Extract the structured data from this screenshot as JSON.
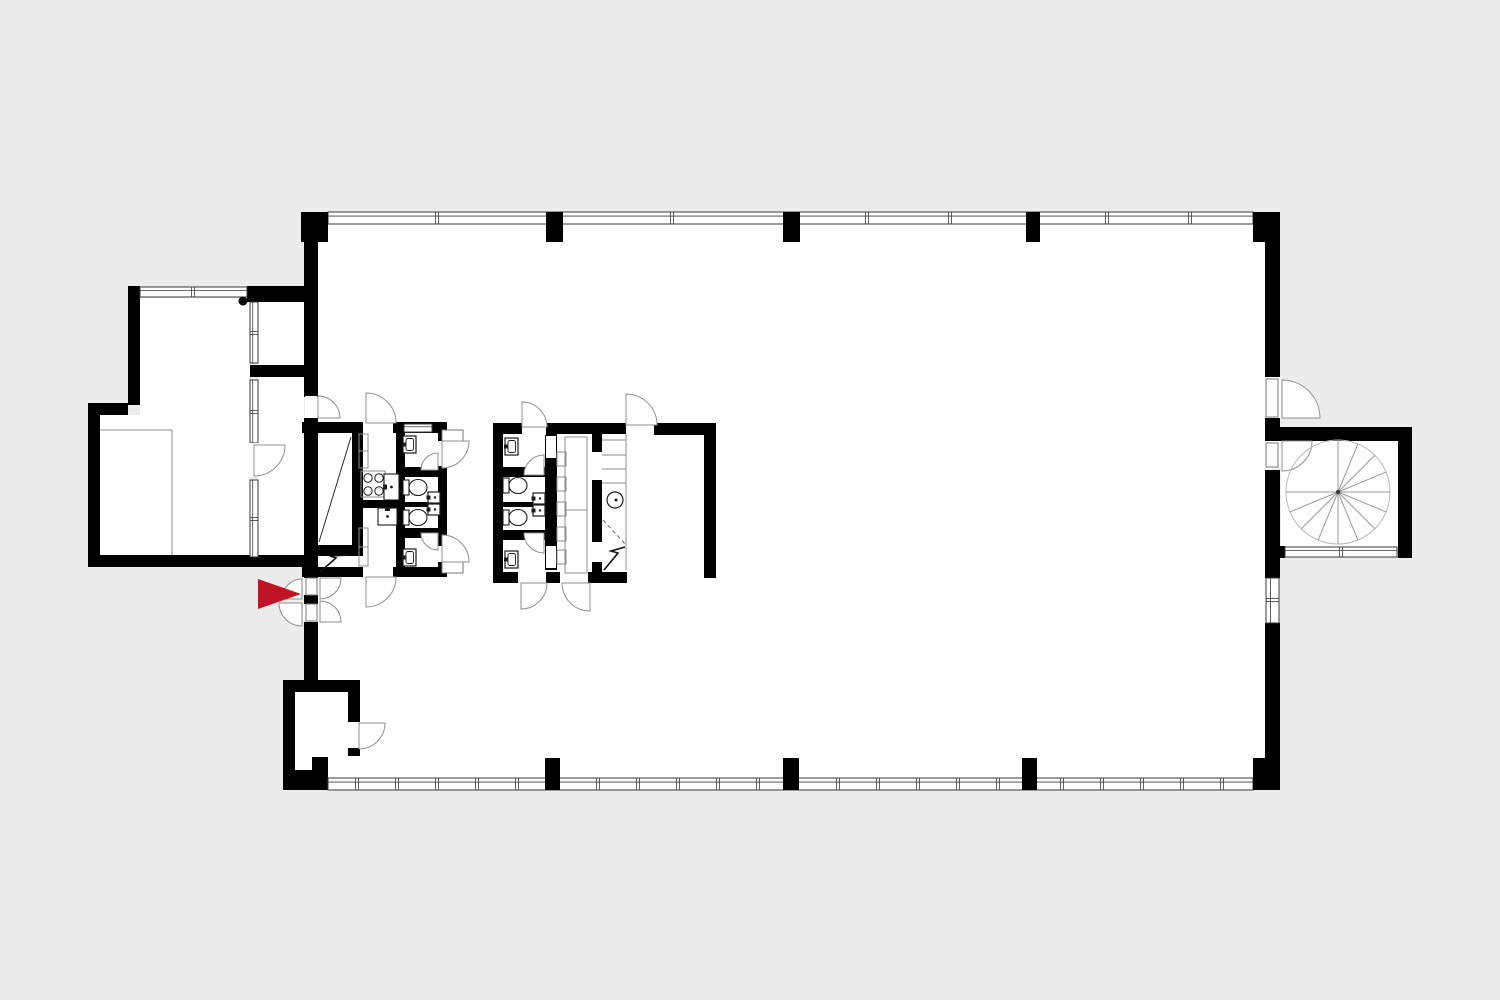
{
  "meta": {
    "description": "Black and white architectural floor plan (ground floor) with two sanitary service cores, a left annex, a spiral staircase on the right and a red entrance arrow marker",
    "canvas": {
      "w": 1500,
      "h": 1000
    }
  },
  "colors": {
    "background": "#ececec",
    "interior": "#ffffff",
    "wall": "#000000",
    "line": "#8f8f8f",
    "window_frame": "#3a3a3a",
    "fixture": "#1b1b1b",
    "accent_red": "#c01425"
  },
  "floorplan": {
    "interiors": [
      {
        "name": "main-hall",
        "r": [
          310,
          220,
          962,
          562
        ]
      },
      {
        "name": "annex-room",
        "r": [
          140,
          298,
          110,
          258
        ]
      },
      {
        "name": "annex-subroom",
        "r": [
          100,
          415,
          40,
          141
        ]
      },
      {
        "name": "vestibule",
        "r": [
          258,
          302,
          46,
          64
        ]
      },
      {
        "name": "corridor",
        "r": [
          258,
          377,
          46,
          178
        ]
      },
      {
        "name": "stair-room",
        "r": [
          1281,
          441,
          117,
          106
        ]
      },
      {
        "name": "storage-room",
        "r": [
          295,
          692,
          53,
          86
        ]
      },
      {
        "name": "shaft",
        "r": [
          318,
          434,
          34,
          111
        ]
      },
      {
        "name": "meter-box",
        "r": [
          318,
          556,
          34,
          16
        ]
      }
    ],
    "walls": [
      [
        304,
        242,
        14,
        155
      ],
      [
        304,
        418,
        14,
        160
      ],
      [
        304,
        594,
        14,
        10
      ],
      [
        304,
        622,
        14,
        58
      ],
      [
        1265,
        242,
        15,
        135
      ],
      [
        1265,
        417,
        15,
        26
      ],
      [
        1265,
        470,
        15,
        108
      ],
      [
        1265,
        623,
        15,
        135
      ],
      [
        1280,
        427,
        132,
        14
      ],
      [
        1398,
        427,
        14,
        131
      ],
      [
        1265,
        546,
        20,
        12
      ],
      [
        1398,
        546,
        14,
        12
      ],
      [
        128,
        286,
        12,
        16
      ],
      [
        247,
        286,
        57,
        16
      ],
      [
        128,
        286,
        12,
        119
      ],
      [
        88,
        403,
        40,
        12
      ],
      [
        88,
        403,
        12,
        164
      ],
      [
        88,
        555,
        230,
        12
      ],
      [
        250,
        365,
        54,
        12
      ],
      [
        302,
        422,
        61,
        11
      ],
      [
        393,
        422,
        54,
        11
      ],
      [
        302,
        567,
        61,
        10
      ],
      [
        393,
        567,
        54,
        10
      ],
      [
        352,
        433,
        11,
        123
      ],
      [
        313,
        545,
        50,
        11
      ],
      [
        396,
        433,
        9,
        134
      ],
      [
        363,
        500,
        33,
        8
      ],
      [
        400,
        467,
        47,
        10
      ],
      [
        400,
        502,
        40,
        5
      ],
      [
        400,
        528,
        47,
        10
      ],
      [
        440,
        487,
        7,
        30
      ],
      [
        438,
        433,
        9,
        8
      ],
      [
        438,
        466,
        9,
        80
      ],
      [
        438,
        562,
        9,
        12
      ],
      [
        493,
        423,
        29,
        11
      ],
      [
        546,
        423,
        80,
        11
      ],
      [
        654,
        423,
        62,
        12
      ],
      [
        704,
        435,
        12,
        143
      ],
      [
        493,
        423,
        10,
        158
      ],
      [
        545,
        434,
        12,
        136
      ],
      [
        592,
        434,
        10,
        18
      ],
      [
        592,
        480,
        10,
        62
      ],
      [
        592,
        562,
        10,
        10
      ],
      [
        493,
        467,
        52,
        10
      ],
      [
        493,
        502,
        44,
        5
      ],
      [
        493,
        530,
        52,
        10
      ],
      [
        493,
        572,
        25,
        11
      ],
      [
        546,
        572,
        14,
        11
      ],
      [
        588,
        572,
        39,
        11
      ],
      [
        283,
        680,
        77,
        12
      ],
      [
        283,
        680,
        12,
        110
      ],
      [
        283,
        770,
        45,
        20
      ],
      [
        312,
        757,
        16,
        14
      ],
      [
        348,
        680,
        12,
        42
      ],
      [
        348,
        748,
        12,
        8
      ]
    ],
    "pillars": [
      [
        301,
        212,
        27,
        30
      ],
      [
        546,
        212,
        17,
        30
      ],
      [
        783,
        212,
        17,
        30
      ],
      [
        1026,
        212,
        14,
        30
      ],
      [
        1253,
        212,
        27,
        30
      ],
      [
        545,
        758,
        15,
        32
      ],
      [
        783,
        758,
        16,
        32
      ],
      [
        1022,
        758,
        15,
        32
      ],
      [
        1253,
        758,
        27,
        32
      ]
    ],
    "windows": [
      {
        "x": 328,
        "y": 212,
        "w": 925,
        "h": 12,
        "o": "h",
        "m": [
          437,
          672,
          867,
          950,
          1107,
          1190
        ]
      },
      {
        "x": 328,
        "y": 778,
        "w": 925,
        "h": 12,
        "o": "h",
        "m": [
          357,
          397,
          437,
          477,
          517,
          598,
          638,
          678,
          718,
          758,
          838,
          878,
          918,
          958,
          998,
          1062,
          1102,
          1142,
          1182,
          1222
        ]
      },
      {
        "x": 140,
        "y": 287,
        "w": 107,
        "h": 10,
        "o": "h",
        "m": [
          193
        ]
      },
      {
        "x": 1285,
        "y": 547,
        "w": 112,
        "h": 10,
        "o": "h",
        "m": [
          1341
        ]
      },
      {
        "x": 404,
        "y": 424,
        "w": 28,
        "h": 8,
        "o": "h",
        "m": []
      },
      {
        "x": 250,
        "y": 302,
        "w": 8,
        "h": 61,
        "o": "v",
        "m": [
          333
        ]
      },
      {
        "x": 250,
        "y": 380,
        "w": 8,
        "h": 63,
        "o": "v",
        "m": [
          412
        ]
      },
      {
        "x": 250,
        "y": 480,
        "w": 8,
        "h": 77,
        "o": "v",
        "m": [
          519
        ]
      },
      {
        "x": 1266,
        "y": 578,
        "w": 13,
        "h": 45,
        "o": "v",
        "m": [
          600
        ]
      }
    ],
    "openings": [
      [
        305,
        396,
        12,
        22
      ],
      [
        249,
        443,
        10,
        34
      ],
      [
        363,
        421,
        30,
        13
      ],
      [
        363,
        566,
        30,
        12
      ],
      [
        438,
        441,
        9,
        25
      ],
      [
        438,
        546,
        9,
        16
      ],
      [
        522,
        422,
        24,
        13
      ],
      [
        626,
        422,
        28,
        14
      ],
      [
        518,
        571,
        28,
        13
      ],
      [
        560,
        571,
        28,
        13
      ],
      [
        546,
        436,
        10,
        22
      ],
      [
        546,
        546,
        10,
        22
      ],
      [
        303,
        578,
        15,
        17
      ],
      [
        303,
        604,
        15,
        17
      ],
      [
        348,
        722,
        12,
        26
      ],
      [
        1264,
        377,
        17,
        41
      ],
      [
        1264,
        441,
        17,
        26
      ]
    ],
    "leaves": [
      [
        1266,
        379,
        12,
        38
      ],
      [
        1266,
        443,
        12,
        24
      ],
      [
        306,
        578,
        11,
        17
      ],
      [
        306,
        604,
        11,
        17
      ],
      [
        442,
        430,
        21,
        11
      ],
      [
        442,
        562,
        21,
        11
      ]
    ],
    "doors": [
      [
        318,
        418,
        22,
        270,
        360
      ],
      [
        254,
        445,
        31,
        0,
        90
      ],
      [
        366,
        423,
        30,
        270,
        360
      ],
      [
        442,
        441,
        27,
        0,
        90
      ],
      [
        438,
        470,
        17,
        180,
        270
      ],
      [
        442,
        562,
        27,
        270,
        360
      ],
      [
        438,
        533,
        17,
        90,
        180
      ],
      [
        366,
        577,
        30,
        0,
        90
      ],
      [
        522,
        427,
        25,
        270,
        360
      ],
      [
        626,
        425,
        31,
        270,
        360
      ],
      [
        544,
        475,
        20,
        180,
        270
      ],
      [
        544,
        533,
        20,
        90,
        180
      ],
      [
        521,
        583,
        26,
        0,
        90
      ],
      [
        590,
        583,
        28,
        90,
        180
      ],
      [
        320,
        578,
        21,
        0,
        90
      ],
      [
        320,
        622,
        21,
        270,
        360
      ],
      [
        302,
        599,
        20,
        180,
        270
      ],
      [
        302,
        603,
        23,
        90,
        180
      ],
      [
        359,
        723,
        26,
        0,
        90
      ],
      [
        1282,
        418,
        38,
        270,
        360
      ],
      [
        1282,
        441,
        30,
        0,
        90
      ]
    ],
    "thin_rects": [
      [
        359,
        434,
        9,
        17
      ],
      [
        359,
        451,
        9,
        17
      ],
      [
        359,
        528,
        9,
        19
      ],
      [
        359,
        547,
        9,
        19
      ],
      [
        557,
        452,
        9,
        14
      ],
      [
        557,
        477,
        9,
        14
      ],
      [
        557,
        502,
        9,
        14
      ],
      [
        557,
        527,
        9,
        14
      ],
      [
        557,
        550,
        9,
        14
      ],
      [
        565,
        437,
        22,
        136
      ],
      [
        361,
        471,
        24,
        26
      ]
    ],
    "thin_lines": [
      [
        172,
        430,
        172,
        555
      ],
      [
        100,
        430,
        172,
        430
      ],
      [
        626,
        434,
        626,
        570
      ],
      [
        565,
        510,
        587,
        510
      ],
      [
        602,
        440,
        626,
        440
      ],
      [
        602,
        455,
        626,
        455
      ],
      [
        602,
        469,
        626,
        469
      ],
      [
        602,
        483,
        626,
        483
      ]
    ],
    "dashed_lines": [
      [
        603,
        520,
        626,
        545
      ]
    ],
    "diagonals": [
      [
        351,
        437,
        319,
        542
      ]
    ],
    "zigzags": [
      [
        [
          320,
          572
        ],
        [
          336,
          558
        ],
        [
          330,
          556
        ],
        [
          350,
          555
        ]
      ],
      [
        [
          604,
          570
        ],
        [
          618,
          553
        ],
        [
          611,
          551
        ],
        [
          625,
          547
        ]
      ]
    ],
    "fixtures": {
      "toilets": [
        [
          403,
          478
        ],
        [
          403,
          508
        ],
        [
          503,
          476
        ],
        [
          503,
          508
        ]
      ],
      "wall_sinks": [
        [
          403,
          436
        ],
        [
          403,
          549
        ],
        [
          505,
          438
        ],
        [
          505,
          551
        ]
      ],
      "small_sinks": [
        [
          428,
          492
        ],
        [
          428,
          504
        ],
        [
          533,
          493
        ],
        [
          533,
          505
        ]
      ],
      "kitchen_sinks": [
        {
          "x": 384,
          "y": 474,
          "w": 15,
          "h": 26,
          "tap": "left"
        },
        {
          "x": 378,
          "y": 508,
          "w": 19,
          "h": 17,
          "tap": "top"
        }
      ],
      "cooktop": {
        "cx": [
          368,
          379
        ],
        "cy": [
          478,
          491
        ],
        "r": 4.2
      },
      "round_basin": {
        "cx": 615,
        "cy": 500,
        "r": 8
      },
      "service_dot": {
        "cx": 243,
        "cy": 301,
        "r": 4.5
      }
    },
    "spiral_stair": {
      "cx": 1338,
      "cy": 492,
      "r": 52,
      "angles": [
        270,
        292.5,
        315,
        337.5,
        0,
        22.5,
        45,
        67.5,
        90,
        112.5,
        135,
        157.5,
        180
      ]
    },
    "entrance_arrow": {
      "points": "258,579 301,594 258,609"
    }
  }
}
